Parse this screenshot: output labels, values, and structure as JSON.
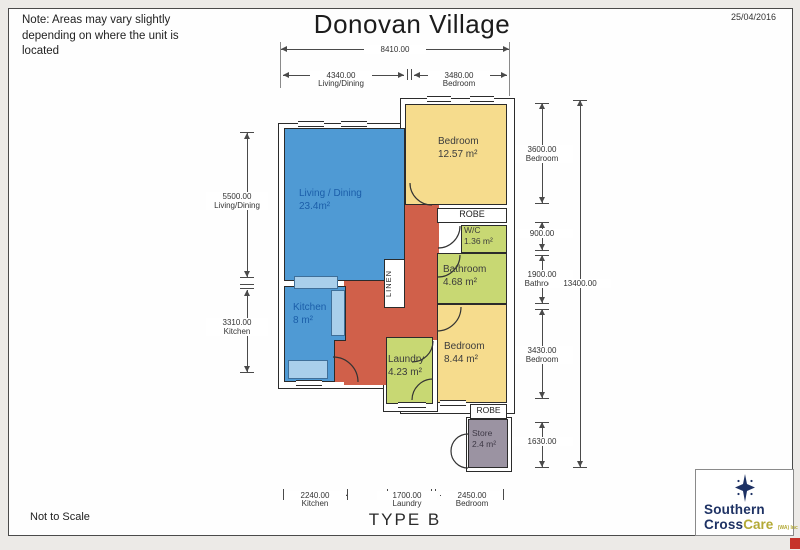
{
  "page": {
    "title": "Donovan Village",
    "date": "25/04/2016",
    "note_lines": [
      "Note: Areas may vary slightly",
      "depending on where the unit is",
      "located"
    ],
    "not_to_scale": "Not to Scale",
    "type_label": "TYPE B"
  },
  "rooms": {
    "living": {
      "name": "Living / Dining",
      "area": "23.4m²"
    },
    "kitchen": {
      "name": "Kitchen",
      "area": "8 m²"
    },
    "bedroom1": {
      "name": "Bedroom",
      "area": "12.57 m²"
    },
    "wc": {
      "name": "W/C",
      "area": "1.36 m²"
    },
    "bathroom": {
      "name": "Bathroom",
      "area": "4.68 m²"
    },
    "bedroom2": {
      "name": "Bedroom",
      "area": "8.44 m²"
    },
    "laundry": {
      "name": "Laundry",
      "area": "4.23 m²"
    },
    "store": {
      "name": "Store",
      "area": "2.4 m²"
    },
    "robe_top": "ROBE",
    "robe_bottom": "ROBE",
    "linen": "LINEN"
  },
  "dims": {
    "top_overall": {
      "value": "8410.00"
    },
    "top_living": {
      "value": "4340.00",
      "label": "Living/Dining"
    },
    "top_bedroom": {
      "value": "3480.00",
      "label": "Bedroom"
    },
    "left_living": {
      "value": "5500.00",
      "label": "Living/Dining"
    },
    "left_kitchen": {
      "value": "3310.00",
      "label": "Kitchen"
    },
    "right_bedroom1": {
      "value": "3600.00",
      "label": "Bedroom"
    },
    "right_wc": {
      "value": "900.00"
    },
    "right_bathroom": {
      "value": "1900.00",
      "label": "Bathroom"
    },
    "right_bedroom2": {
      "value": "3430.00",
      "label": "Bedroom"
    },
    "right_store": {
      "value": "1630.00"
    },
    "right_overall": {
      "value": "13400.00"
    },
    "bottom_kitchen": {
      "value": "2240.00",
      "label": "Kitchen"
    },
    "bottom_laundry": {
      "value": "1700.00",
      "label": "Laundry"
    },
    "bottom_bedroom": {
      "value": "2450.00",
      "label": "Bedroom"
    }
  },
  "logo": {
    "word1": "Southern",
    "word2": "Cross",
    "word3": "Care",
    "suffix": "(WA) Inc"
  },
  "colors": {
    "living_kitchen": "#4f9ad4",
    "bedrooms": "#f6dc8d",
    "wet_areas": "#c8d873",
    "hallway": "#d0604a",
    "store": "#9b93a2",
    "logo_navy": "#1e3264",
    "logo_gold": "#b3a935"
  }
}
